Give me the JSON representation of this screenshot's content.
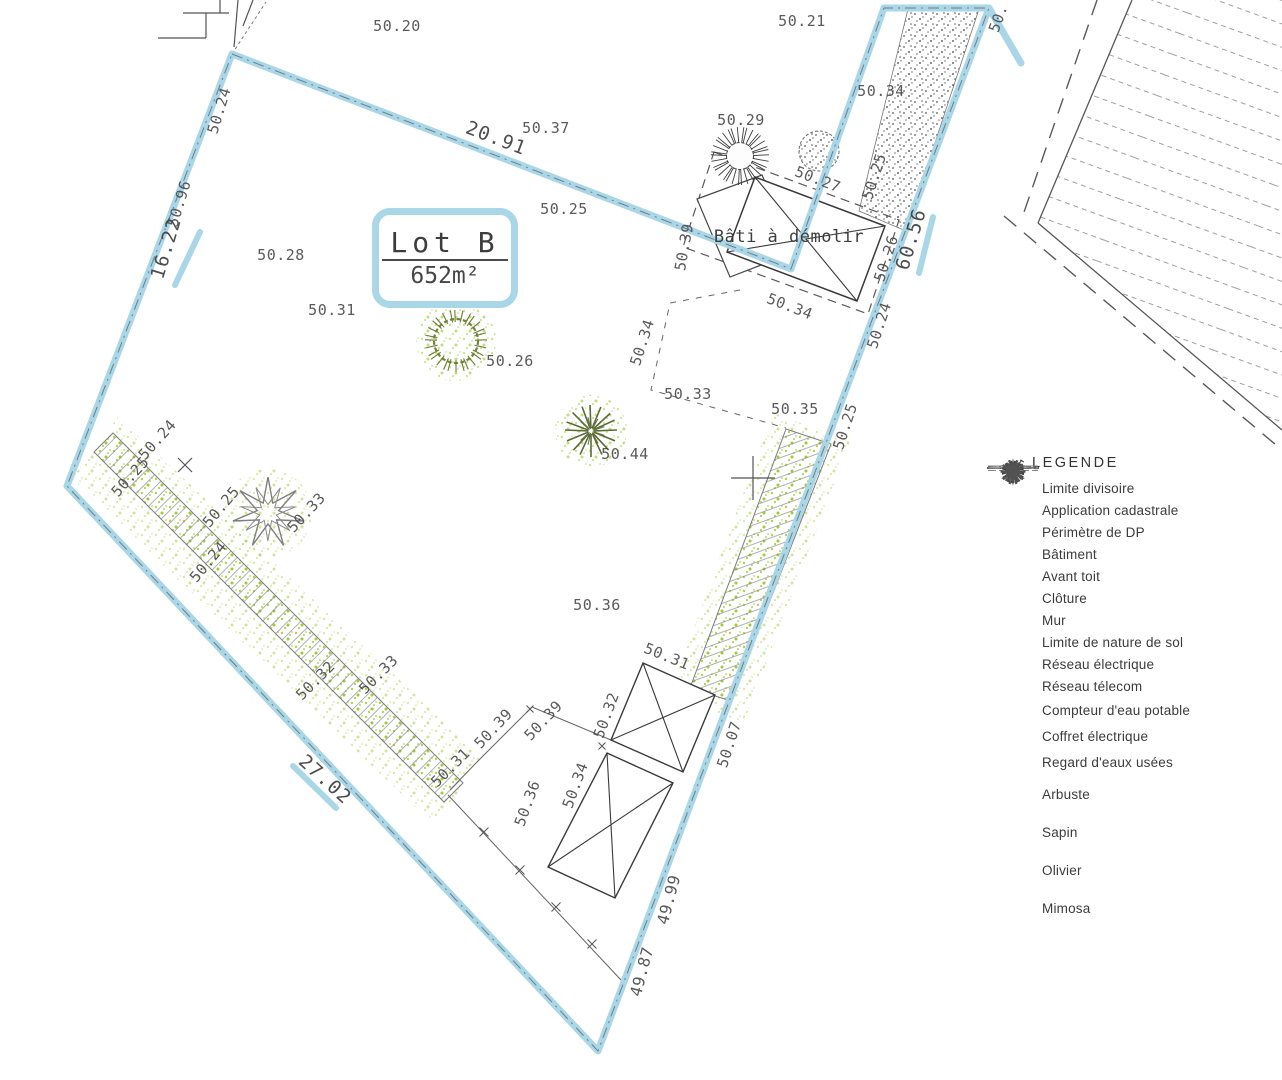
{
  "plan": {
    "lot_label": "Lot B",
    "lot_area": "652m²",
    "bati_label": "Bâti à démolir",
    "labels": [
      {
        "text": "50.20",
        "x": 397,
        "y": 31,
        "rot": 0
      },
      {
        "text": "50.21",
        "x": 802,
        "y": 26,
        "rot": 0
      },
      {
        "text": "50.24",
        "x": 224,
        "y": 112,
        "rot": -73
      },
      {
        "text": "50.96",
        "x": 184,
        "y": 205,
        "rot": -73
      },
      {
        "text": "16.22",
        "x": 172,
        "y": 250,
        "rot": -73,
        "size": 19
      },
      {
        "text": "20.91",
        "x": 494,
        "y": 144,
        "rot": 21,
        "size": 19
      },
      {
        "text": "50.37",
        "x": 546,
        "y": 133,
        "rot": 0
      },
      {
        "text": "50.25",
        "x": 564,
        "y": 214,
        "rot": 0
      },
      {
        "text": "50.29",
        "x": 741,
        "y": 125,
        "rot": 0
      },
      {
        "text": "50.27",
        "x": 816,
        "y": 184,
        "rot": 21
      },
      {
        "text": "50.34",
        "x": 881,
        "y": 96,
        "rot": 0
      },
      {
        "text": "50.25",
        "x": 879,
        "y": 178,
        "rot": -72
      },
      {
        "text": "50.39",
        "x": 689,
        "y": 248,
        "rot": -80
      },
      {
        "text": "60.56",
        "x": 917,
        "y": 241,
        "rot": -73,
        "size": 19
      },
      {
        "text": "50.26",
        "x": 891,
        "y": 260,
        "rot": -72
      },
      {
        "text": "50.24",
        "x": 884,
        "y": 327,
        "rot": -72
      },
      {
        "text": "50.34",
        "x": 788,
        "y": 311,
        "rot": 21
      },
      {
        "text": "50.34",
        "x": 647,
        "y": 344,
        "rot": -72
      },
      {
        "text": "50.33",
        "x": 688,
        "y": 399,
        "rot": 0
      },
      {
        "text": "50.35",
        "x": 795,
        "y": 414,
        "rot": 0
      },
      {
        "text": "50.25",
        "x": 850,
        "y": 428,
        "rot": -72
      },
      {
        "text": "50.28",
        "x": 281,
        "y": 260,
        "rot": 0
      },
      {
        "text": "50.31",
        "x": 332,
        "y": 315,
        "rot": 0
      },
      {
        "text": "50.26",
        "x": 510,
        "y": 366,
        "rot": 0
      },
      {
        "text": "50.44",
        "x": 625,
        "y": 459,
        "rot": 0
      },
      {
        "text": "50.24",
        "x": 161,
        "y": 443,
        "rot": -48
      },
      {
        "text": "50.25",
        "x": 134,
        "y": 480,
        "rot": -48
      },
      {
        "text": "50.25",
        "x": 225,
        "y": 510,
        "rot": -50
      },
      {
        "text": "50.24",
        "x": 212,
        "y": 565,
        "rot": -50
      },
      {
        "text": "50.33",
        "x": 310,
        "y": 516,
        "rot": -47
      },
      {
        "text": "50.32",
        "x": 319,
        "y": 684,
        "rot": -45
      },
      {
        "text": "50.33",
        "x": 382,
        "y": 678,
        "rot": -45
      },
      {
        "text": "50.31",
        "x": 454,
        "y": 771,
        "rot": -45
      },
      {
        "text": "27.02",
        "x": 321,
        "y": 784,
        "rot": 42,
        "size": 19
      },
      {
        "text": "50.36",
        "x": 597,
        "y": 610,
        "rot": 0
      },
      {
        "text": "50.31",
        "x": 665,
        "y": 661,
        "rot": 22
      },
      {
        "text": "50.32",
        "x": 611,
        "y": 717,
        "rot": -70
      },
      {
        "text": "50.39",
        "x": 497,
        "y": 732,
        "rot": -47
      },
      {
        "text": "50.39",
        "x": 547,
        "y": 724,
        "rot": -47
      },
      {
        "text": "50.34",
        "x": 580,
        "y": 787,
        "rot": -70
      },
      {
        "text": "50.36",
        "x": 532,
        "y": 805,
        "rot": -70
      },
      {
        "text": "50.07",
        "x": 734,
        "y": 746,
        "rot": -72
      },
      {
        "text": "49.99",
        "x": 674,
        "y": 901,
        "rot": -75,
        "size": 16
      },
      {
        "text": "49.87",
        "x": 647,
        "y": 973,
        "rot": -75,
        "size": 16
      },
      {
        "text": "50.",
        "x": 1003,
        "y": 20,
        "rot": -70
      }
    ]
  },
  "legend": {
    "title": "LEGENDE",
    "items": [
      {
        "icon": "limite-divisoire",
        "label": "Limite divisoire"
      },
      {
        "icon": "application-cadastrale",
        "label": "Application cadastrale"
      },
      {
        "icon": "perimetre-dp",
        "label": "Périmètre de DP"
      },
      {
        "icon": "batiment",
        "label": "Bâtiment"
      },
      {
        "icon": "avant-toit",
        "label": "Avant toit"
      },
      {
        "icon": "cloture",
        "label": "Clôture"
      },
      {
        "icon": "mur",
        "label": "Mur"
      },
      {
        "icon": "limite-nature-sol",
        "label": "Limite de nature de sol"
      },
      {
        "icon": "reseau-electrique",
        "label": "Réseau électrique"
      },
      {
        "icon": "reseau-telecom",
        "label": "Réseau télecom"
      },
      {
        "icon": "compteur-eau",
        "label": "Compteur d'eau potable"
      },
      {
        "icon": "coffret-electrique",
        "label": "Coffret électrique"
      },
      {
        "icon": "regard-eaux",
        "label": "Regard d'eaux usées"
      },
      {
        "icon": "arbuste",
        "label": "Arbuste"
      },
      {
        "icon": "sapin",
        "label": "Sapin"
      },
      {
        "icon": "olivier",
        "label": "Olivier"
      },
      {
        "icon": "mimosa",
        "label": "Mimosa"
      }
    ]
  },
  "colors": {
    "boundary_blue": "#a9d7e8",
    "hedge_green": "#aecb45",
    "draw_grey": "#4d4d4d"
  }
}
